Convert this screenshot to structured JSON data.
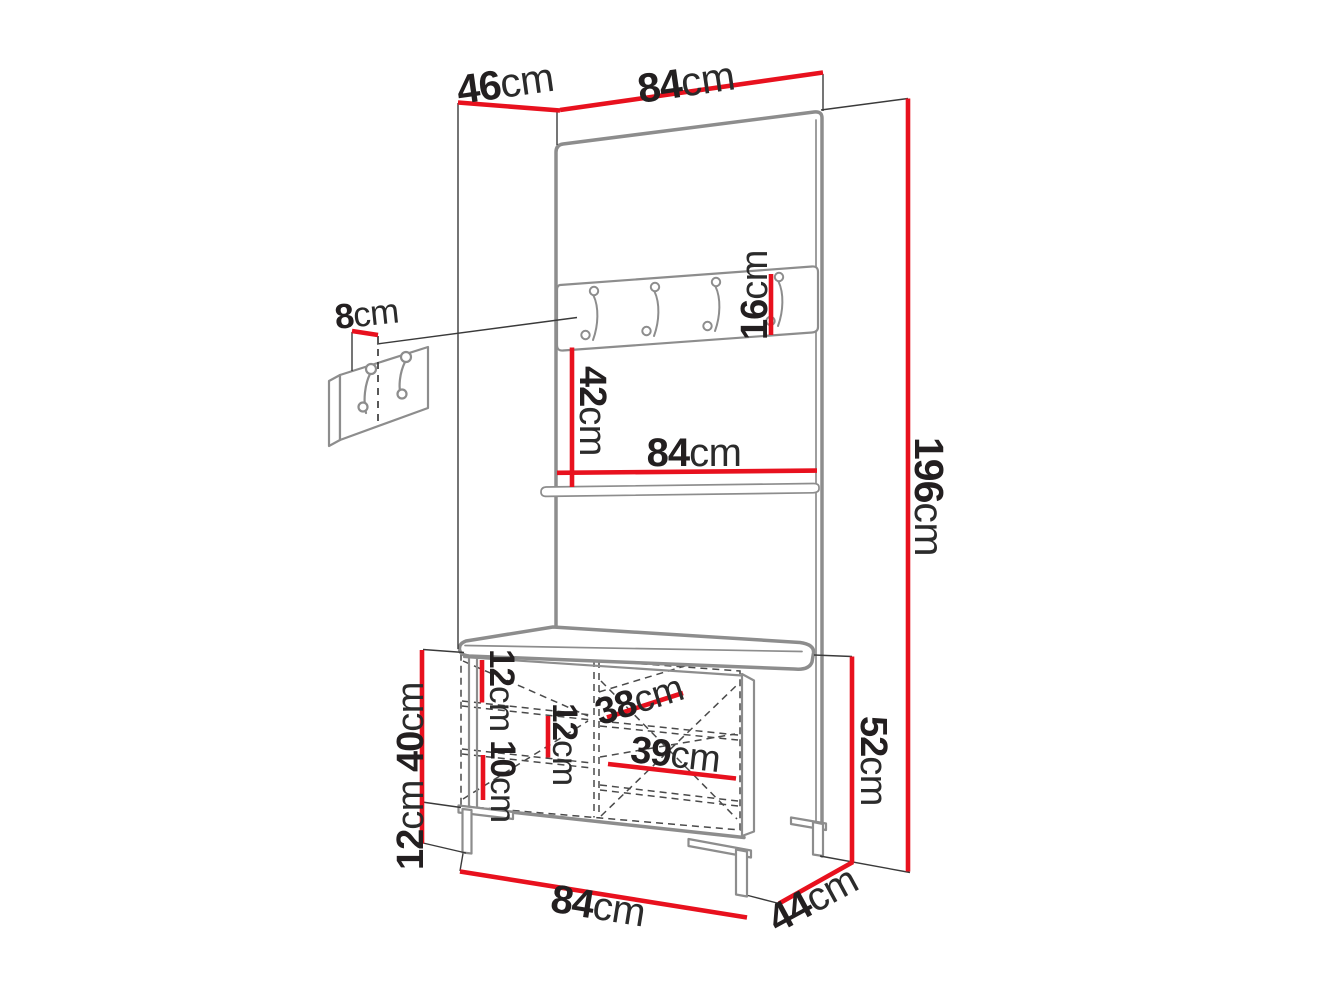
{
  "diagram": {
    "title": "Hallway furniture set dimension drawing",
    "unit_system": "cm",
    "colors": {
      "dimension_line": "#e8111e",
      "furniture_outline": "#8d8d8d",
      "extension_line": "#3a3a3a",
      "label_text": "#231f20"
    },
    "dims": {
      "top_depth": {
        "value": "46",
        "unit": "cm"
      },
      "top_width": {
        "value": "84",
        "unit": "cm"
      },
      "total_height": {
        "value": "196",
        "unit": "cm"
      },
      "hook_rail_height": {
        "value": "16",
        "unit": "cm"
      },
      "rail_to_shelf": {
        "value": "42",
        "unit": "cm"
      },
      "panel_width": {
        "value": "84",
        "unit": "cm"
      },
      "wall_hook_offset": {
        "value": "8",
        "unit": "cm"
      },
      "cabinet_height": {
        "value": "40",
        "unit": "cm"
      },
      "leg_height": {
        "value": "12",
        "unit": "cm"
      },
      "gap_top_left": {
        "value": "12",
        "unit": "cm"
      },
      "gap_middle": {
        "value": "12",
        "unit": "cm"
      },
      "gap_bottom_left": {
        "value": "10",
        "unit": "cm"
      },
      "left_compartment": {
        "value": "38",
        "unit": "cm"
      },
      "right_compartment": {
        "value": "39",
        "unit": "cm"
      },
      "bench_height": {
        "value": "52",
        "unit": "cm"
      },
      "bench_width": {
        "value": "84",
        "unit": "cm"
      },
      "bench_depth": {
        "value": "44",
        "unit": "cm"
      }
    }
  }
}
